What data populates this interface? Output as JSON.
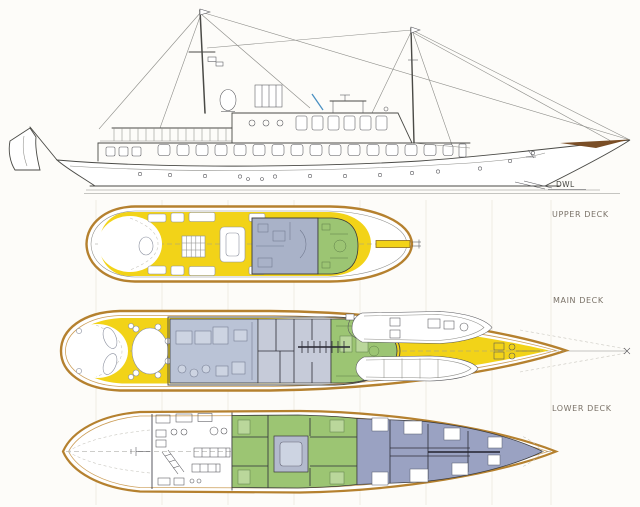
{
  "document": {
    "kind": "yacht general-arrangement drawing",
    "views": [
      "profile",
      "upper deck plan",
      "main deck plan",
      "lower deck plan"
    ]
  },
  "labels": {
    "dwl": "DWL",
    "upper_deck": "UPPER DECK",
    "main_deck": "MAIN DECK",
    "lower_deck": "LOWER DECK"
  },
  "colors": {
    "paper": "#fdfcf9",
    "ink": "#4a4a46",
    "hull_outline": "#b5812f",
    "hull_outline_inner": "#cc9e58",
    "deck_yellow": "#f2d318",
    "bridge_blue": "#a9b2c8",
    "salon_blue": "#bac3d6",
    "mid_gray": "#c6cbd9",
    "room_green": "#9cc573",
    "green_light": "#bad79b",
    "lower_purple": "#9aa2c2",
    "casing_blue": "#b3bacd",
    "accent_blue": "#4a90c2",
    "bowsprit_brown": "#7a4e26",
    "label_gray": "#7a7268",
    "furniture_line": "#8a8f9e",
    "station_line": "#eae6dc"
  }
}
